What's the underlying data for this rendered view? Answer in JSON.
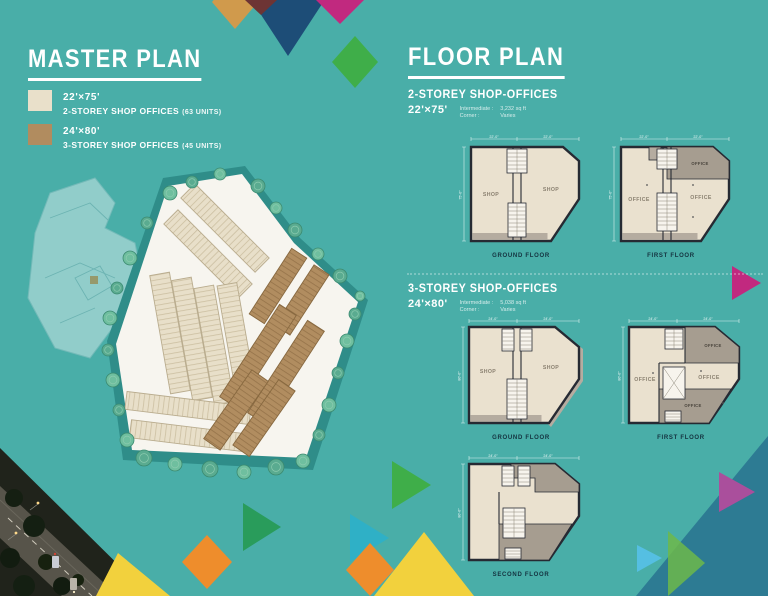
{
  "page": {
    "background": "#49aea8"
  },
  "master_plan": {
    "title": "MASTER PLAN",
    "legend": [
      {
        "size": "22'×75'",
        "name": "2-STOREY SHOP OFFICES",
        "units": "(63 UNITS)",
        "color": "#e9e0ca"
      },
      {
        "size": "24'×80'",
        "name": "3-STOREY SHOP OFFICES",
        "units": "(45 UNITS)",
        "color": "#b18c5f"
      }
    ]
  },
  "floor_plan": {
    "title": "FLOOR PLAN",
    "sections": [
      {
        "heading": "2-STOREY SHOP-OFFICES",
        "size": "22'×75'",
        "note1_label": "Intermediate :",
        "note1_value": "3,232 sq ft",
        "note2_label": "Corner :",
        "note2_value": "Varies",
        "dims": {
          "top_a": "22'-0\"",
          "top_b": "22'-0\"",
          "left": "75'-0\""
        },
        "plans": [
          {
            "label": "GROUND FLOOR",
            "room1": "SHOP",
            "room2": "SHOP"
          },
          {
            "label": "FIRST FLOOR",
            "room1": "OFFICE",
            "room2": "OFFICE",
            "room3": "OFFICE"
          }
        ]
      },
      {
        "heading": "3-STOREY SHOP-OFFICES",
        "size": "24'×80'",
        "note1_label": "Intermediate :",
        "note1_value": "5,038 sq ft",
        "note2_label": "Corner :",
        "note2_value": "Varies",
        "dims": {
          "top_a": "24'-0\"",
          "top_b": "24'-0\"",
          "left": "80'-0\""
        },
        "plans": [
          {
            "label": "GROUND FLOOR",
            "room1": "SHOP",
            "room2": "SHOP"
          },
          {
            "label": "FIRST FLOOR",
            "room1": "OFFICE",
            "room2": "OFFICE",
            "room3": "OFFICE",
            "room4": "OFFICE"
          },
          {
            "label": "SECOND FLOOR"
          }
        ]
      }
    ]
  },
  "site": {
    "colors": {
      "site_border": "#2f8d89",
      "site_roads": "#f7f5ef",
      "two_storey_block": "#e8dfc9",
      "three_storey_block": "#b18d60",
      "trees": "#57a98c"
    }
  }
}
